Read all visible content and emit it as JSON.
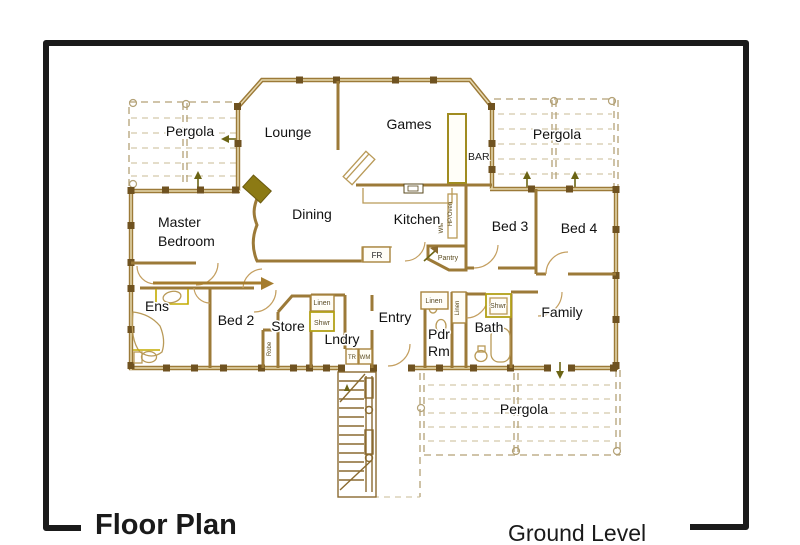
{
  "titles": {
    "floor_plan": "Floor Plan",
    "ground_level": "Ground Level"
  },
  "rooms": {
    "pergola_tl": "Pergola",
    "lounge": "Lounge",
    "games": "Games",
    "pergola_tr": "Pergola",
    "master_1": "Master",
    "master_2": "Bedroom",
    "dining": "Dining",
    "kitchen": "Kitchen",
    "bed3": "Bed 3",
    "bed4": "Bed 4",
    "ens": "Ens",
    "bed2": "Bed 2",
    "store": "Store",
    "lndry": "Lndry",
    "entry": "Entry",
    "pdr_1": "Pdr",
    "pdr_2": "Rm",
    "bath": "Bath",
    "family": "Family",
    "pergola_bottom": "Pergola"
  },
  "fixtures": {
    "bar": "BAR",
    "fr": "FR",
    "pantry": "Pantry",
    "hp_oven": "HP/Oven",
    "wm_kitchen": "WM",
    "linen_hall": "Linen",
    "linen_tall": "Linen",
    "linen_lndry": "Linen",
    "shwr_lndry": "Shwr",
    "shwr_bath": "Shwr",
    "robe": "Robe",
    "tr": "TR",
    "wm": "WM"
  },
  "colors": {
    "frame": "#1a1a1a",
    "wall": "#9c7a38",
    "wall_dark": "#6f5220",
    "wall_light": "#e7d9b0",
    "pergola_dash": "#b3a176",
    "plan_ink": "#5a4a1e",
    "label": "#111111",
    "fireplace": "#8c7a14",
    "accent_yellow": "#c3ab00",
    "arrow_olive": "#6b6414"
  }
}
